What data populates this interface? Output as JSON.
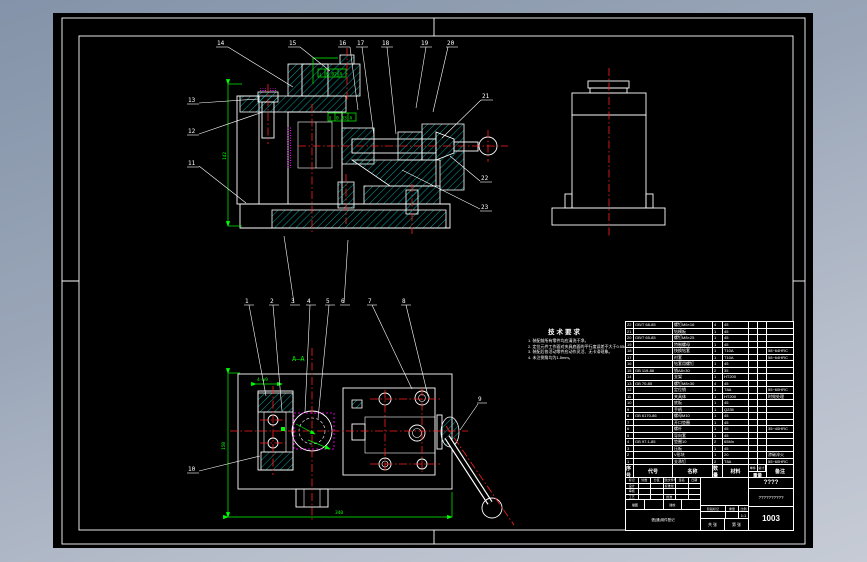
{
  "colors": {
    "background_top": "#8493a9",
    "background_bottom": "#c6cbd5",
    "canvas": "#000000",
    "line": "#ffffff",
    "hatch": "#00e5e5",
    "centerline": "#ff2020",
    "dimension": "#00ff00",
    "hidden_detail": "#ff00ff"
  },
  "balloons": [
    "1",
    "2",
    "3",
    "4",
    "5",
    "6",
    "7",
    "8",
    "9",
    "10",
    "11",
    "12",
    "13",
    "14",
    "15",
    "16",
    "17",
    "18",
    "19",
    "20",
    "21",
    "22",
    "23"
  ],
  "dims": {
    "section_height": "142",
    "plan_height": "150",
    "plan_width": "340",
    "hole_callout": "4-φ9",
    "section_label": "A—A",
    "gdt1_sym": "⊥",
    "gdt1_tol": "0.02",
    "gdt1_datum": "A",
    "gdt2_sym": "∥",
    "gdt2_tol": "0.03",
    "gdt2_datum": "A"
  },
  "notes": {
    "title": "技术要求",
    "items": [
      "1. 装配前所有零件均应清洗干净。",
      "2. 定位元件工作面对夹具底面的平行度误差不大于0.05/100mm。",
      "3. 装配后各活动零件应动作灵活、无卡滞现象。",
      "4. 未注倒角均为1.5mm。"
    ]
  },
  "parts_table": {
    "headers": {
      "seq": "序号",
      "code": "代号",
      "name": "名称",
      "qty": "数量",
      "mat": "材料",
      "unit": "单件",
      "total": "总计",
      "weight": "重量",
      "remark": "备注"
    },
    "rows": [
      [
        "22",
        "GB/T 68-85",
        "螺钉M6×16",
        "4",
        "45",
        "",
        "",
        ""
      ],
      [
        "21",
        "",
        "钻模板",
        "1",
        "45",
        "",
        "",
        ""
      ],
      [
        "20",
        "GB/T 65-85",
        "螺钉M8×25",
        "1",
        "45",
        "",
        "",
        ""
      ],
      [
        "19",
        "",
        "特制螺母",
        "1",
        "45",
        "",
        "",
        ""
      ],
      [
        "18",
        "",
        "快换钻套",
        "1",
        "T10A",
        "",
        "",
        "58~64HRC"
      ],
      [
        "17",
        "",
        "衬套",
        "1",
        "T10A",
        "",
        "",
        "58~64HRC"
      ],
      [
        "16",
        "",
        "钻套用螺钉",
        "1",
        "45",
        "",
        "",
        ""
      ],
      [
        "15",
        "GB 119-86",
        "销A8×30",
        "2",
        "35",
        "",
        "",
        ""
      ],
      [
        "14",
        "",
        "支架",
        "1",
        "HT200",
        "",
        "",
        ""
      ],
      [
        "13",
        "GB 70-85",
        "螺钉M8×30",
        "4",
        "45",
        "",
        "",
        ""
      ],
      [
        "12",
        "",
        "定位销",
        "1",
        "T8A",
        "",
        "",
        "55~60HRC"
      ],
      [
        "11",
        "",
        "夹具体",
        "1",
        "HT200",
        "",
        "",
        "时效处理"
      ],
      [
        "10",
        "",
        "底板",
        "1",
        "45",
        "",
        "",
        ""
      ],
      [
        "9",
        "",
        "手柄",
        "1",
        "Q235",
        "",
        "",
        ""
      ],
      [
        "8",
        "GB 6170-86",
        "螺母M10",
        "1",
        "45",
        "",
        "",
        ""
      ],
      [
        "7",
        "",
        "开口垫圈",
        "1",
        "45",
        "",
        "",
        ""
      ],
      [
        "6",
        "",
        "螺杆",
        "1",
        "45",
        "",
        "",
        "35~40HRC"
      ],
      [
        "5",
        "",
        "导向套",
        "1",
        "45",
        "",
        "",
        ""
      ],
      [
        "4",
        "GB 97.1-85",
        "垫圈10",
        "2",
        "65Mn",
        "",
        "",
        ""
      ],
      [
        "3",
        "",
        "压板",
        "1",
        "45",
        "",
        "",
        ""
      ],
      [
        "2",
        "",
        "V形块",
        "1",
        "20",
        "",
        "",
        "渗碳淬火"
      ],
      [
        "1",
        "",
        "支承钉",
        "2",
        "T8A",
        "",
        "",
        "55~60HRC"
      ]
    ]
  },
  "title_block": {
    "row1": [
      "标记",
      "处数",
      "分区",
      "更改文件号",
      "签名",
      "日期"
    ],
    "row2": [
      "设计",
      "",
      "",
      "标准化",
      "",
      ""
    ],
    "row3": [
      "审核",
      "",
      "",
      "",
      "",
      ""
    ],
    "row4": [
      "工艺",
      "",
      "",
      "批准",
      "",
      ""
    ],
    "row5": [
      "描图",
      "",
      "描校",
      ""
    ],
    "reg_note": "借(通)用件登记",
    "stage_label": "阶段标记",
    "weight_label": "重量",
    "scale_label": "比例",
    "scale_value": "1:1",
    "sheets": "共 张",
    "sheet_no": "第 张",
    "name_top": "????",
    "name_mid": "??????????",
    "drawing_no": "1003"
  }
}
